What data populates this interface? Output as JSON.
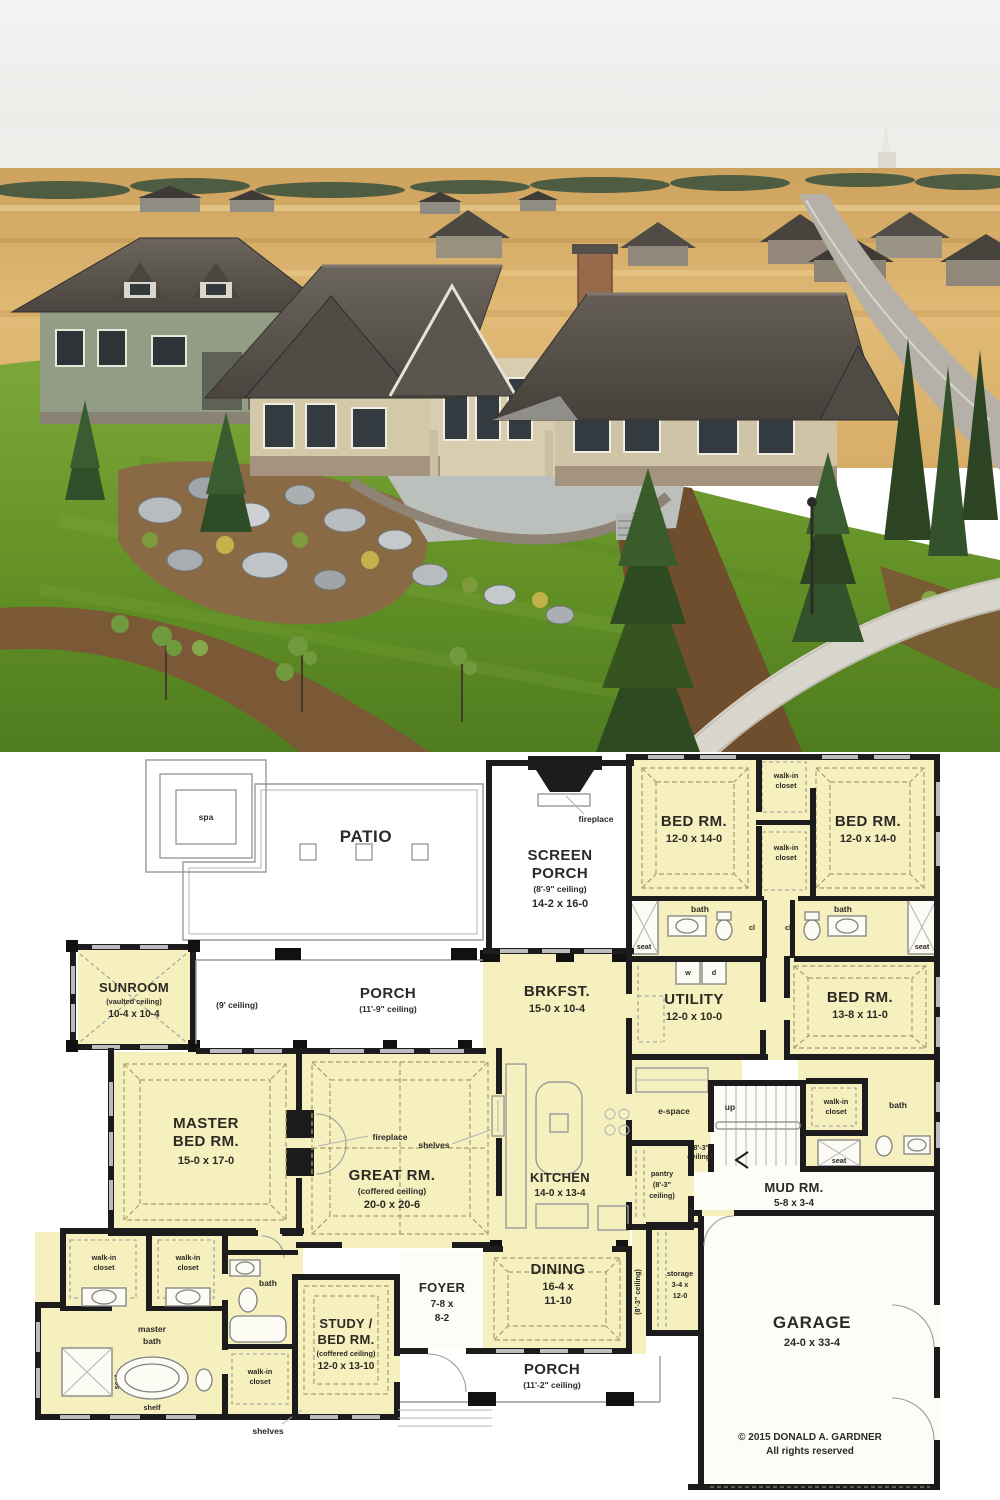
{
  "plan": {
    "labels": {
      "spa": "spa",
      "bath": "bath",
      "seat": "seat",
      "cl": "cl",
      "w": "w",
      "d": "d",
      "up": "up",
      "shelf": "shelf",
      "shelves": "shelves",
      "fireplace": "fireplace",
      "espace": "e-space",
      "ceil9": "(9' ceiling)",
      "ceil83a": "(8'-3\"",
      "ceil83b": "ceiling)",
      "ceil83v": "(8'-3\" ceiling)",
      "wic1": "walk-in",
      "wic2": "closet"
    },
    "patio": {
      "name": "PATIO"
    },
    "screen_porch": {
      "n1": "SCREEN",
      "n2": "PORCH",
      "ceil": "(8'-9\" ceiling)",
      "size": "14-2 x 16-0"
    },
    "bed2": {
      "name": "BED RM.",
      "size": "12-0 x 14-0"
    },
    "bed3": {
      "name": "BED RM.",
      "size": "12-0 x 14-0"
    },
    "bed4": {
      "name": "BED RM.",
      "size": "13-8 x 11-0"
    },
    "utility": {
      "name": "UTILITY",
      "size": "12-0 x 10-0"
    },
    "sunroom": {
      "name": "SUNROOM",
      "ceil": "(vaulted ceiling)",
      "size": "10-4 x 10-4"
    },
    "rear_porch": {
      "name": "PORCH",
      "ceil": "(11'-9\" ceiling)"
    },
    "brkfst": {
      "name": "BRKFST.",
      "size": "15-0 x 10-4"
    },
    "master": {
      "n1": "MASTER",
      "n2": "BED RM.",
      "size": "15-0 x 17-0"
    },
    "great": {
      "name": "GREAT RM.",
      "ceil": "(coffered ceiling)",
      "size": "20-0 x 20-6"
    },
    "kitchen": {
      "name": "KITCHEN",
      "size": "14-0 x 13-4"
    },
    "mud": {
      "name": "MUD RM.",
      "size": "5-8 x 3-4"
    },
    "pantry": {
      "n": "pantry"
    },
    "storage": {
      "n": "storage",
      "s1": "3-4 x",
      "s2": "12-0"
    },
    "garage": {
      "name": "GARAGE",
      "size": "24-0 x 33-4"
    },
    "masterbath": {
      "n1": "master",
      "n2": "bath"
    },
    "study": {
      "n1": "STUDY /",
      "n2": "BED RM.",
      "ceil": "(coffered ceiling)",
      "size": "12-0 x 13-10"
    },
    "foyer": {
      "name": "FOYER",
      "s1": "7-8 x",
      "s2": "8-2"
    },
    "dining": {
      "name": "DINING",
      "s1": "16-4 x",
      "s2": "11-10"
    },
    "front_porch": {
      "name": "PORCH",
      "ceil": "(11'-2\" ceiling)"
    },
    "copyright": {
      "l1": "© 2015 DONALD A. GARDNER",
      "l2": "All rights reserved"
    }
  }
}
